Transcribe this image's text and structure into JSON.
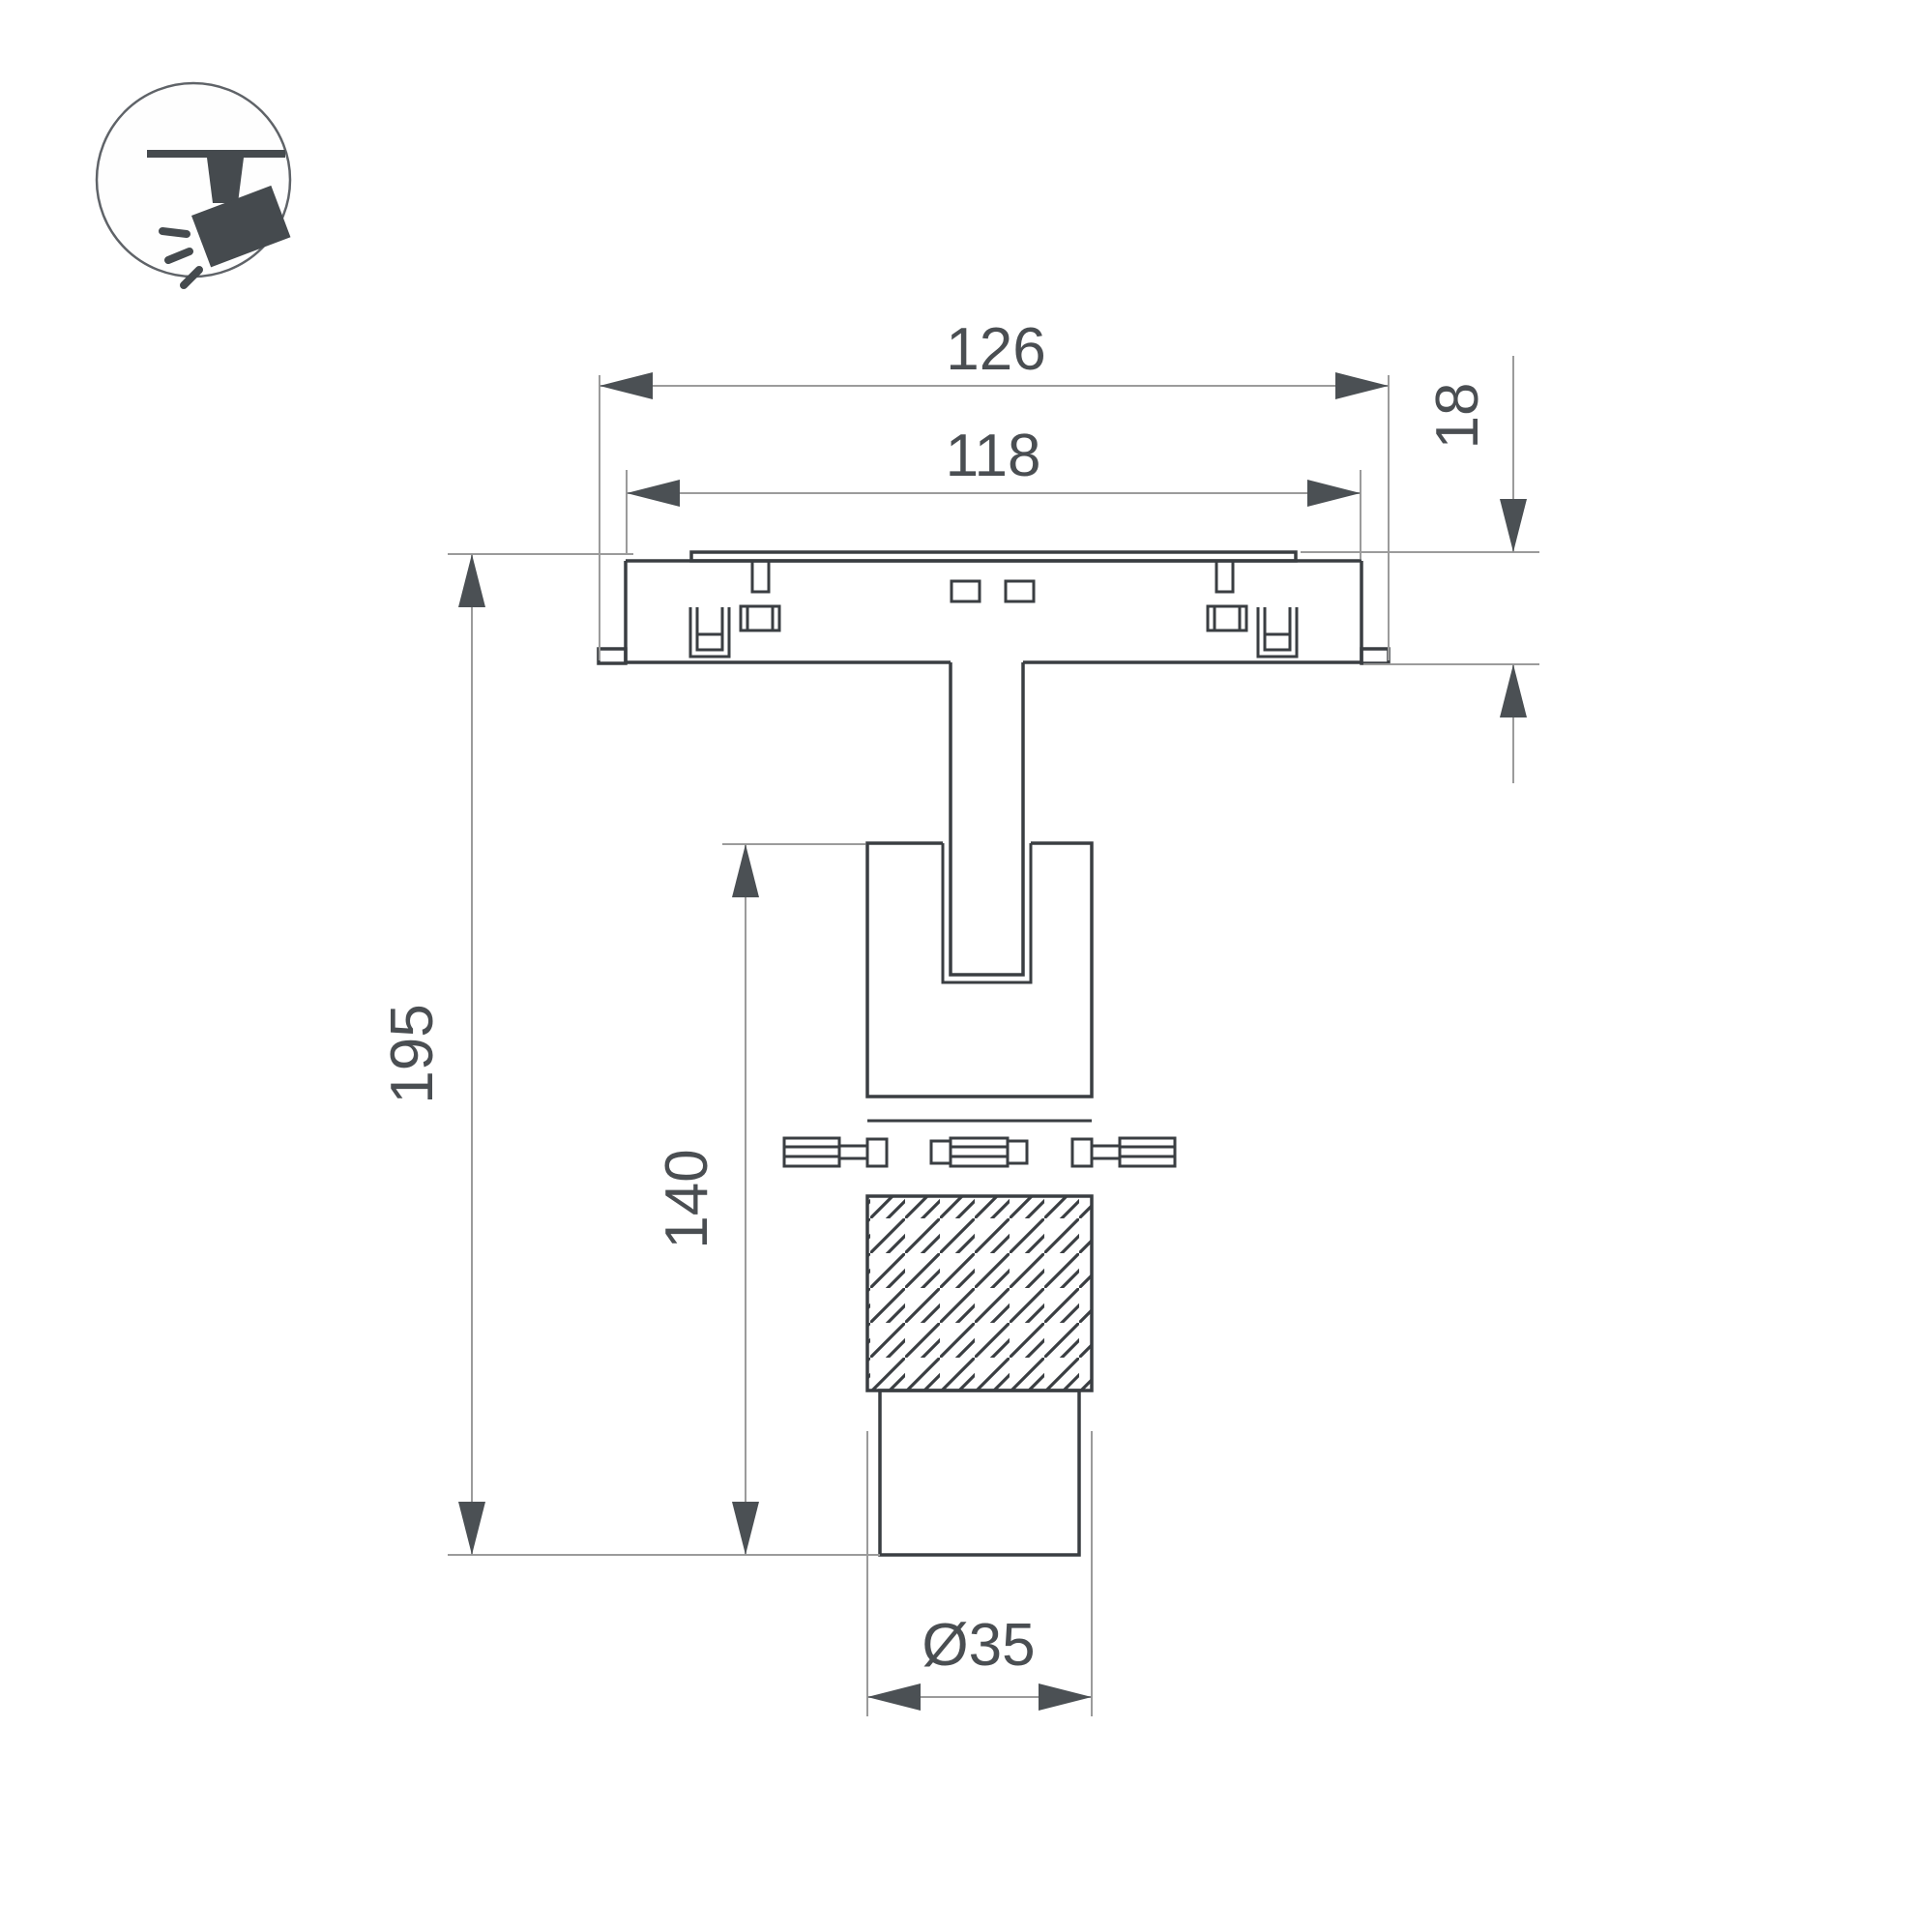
{
  "drawing": {
    "dimensions": {
      "overall_width": "126",
      "mount_width": "118",
      "track_depth": "18",
      "overall_height": "195",
      "body_height": "140",
      "diameter": "Ø35"
    },
    "colors": {
      "outline": "#3a3e42",
      "dim_line": "#9b9b9b",
      "arrow": "#4b5054",
      "label": "#4a4e52",
      "icon": "#454a4e",
      "icon_circle": "#5f6368",
      "background": "#ffffff"
    },
    "icon": {
      "name": "ceiling-track-spotlight-icon"
    }
  }
}
